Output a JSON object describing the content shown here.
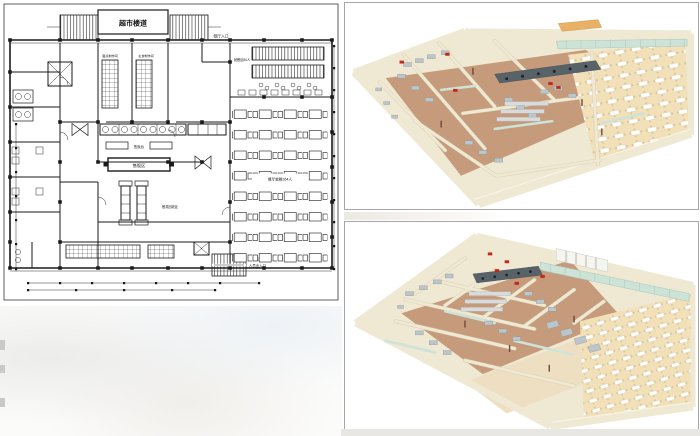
{
  "palette": {
    "ink": "#1a1a1a",
    "frame": "#a5a5a5",
    "wall": "#efe8d3",
    "wall_edge": "#d7cdaf",
    "kfloor": "#c59b7b",
    "dfloor": "#f2e0b8",
    "glass": "#cde3d8",
    "glass_frame": "#a6c8ba",
    "steel": "#bcc5c9",
    "steel_dark": "#8e999e",
    "hood": "#586269",
    "red": "#c4291d",
    "orange": "#e8b165",
    "skylight": "#f6f6f1"
  },
  "floor_plan": {
    "title": "超市楼道",
    "labels": {
      "entrance_top_right": "餐厅入口",
      "small_dining": "就餐区84人",
      "prep_left": "面点制作间",
      "prep_right": "主食制作间",
      "serving_counter": "售饭台",
      "serving_area": "售饭区",
      "dish_return": "餐具回收区",
      "main_dining": "餐厅就餐264人",
      "exit": "出入口",
      "staff_exit": "人员出入口"
    }
  }
}
